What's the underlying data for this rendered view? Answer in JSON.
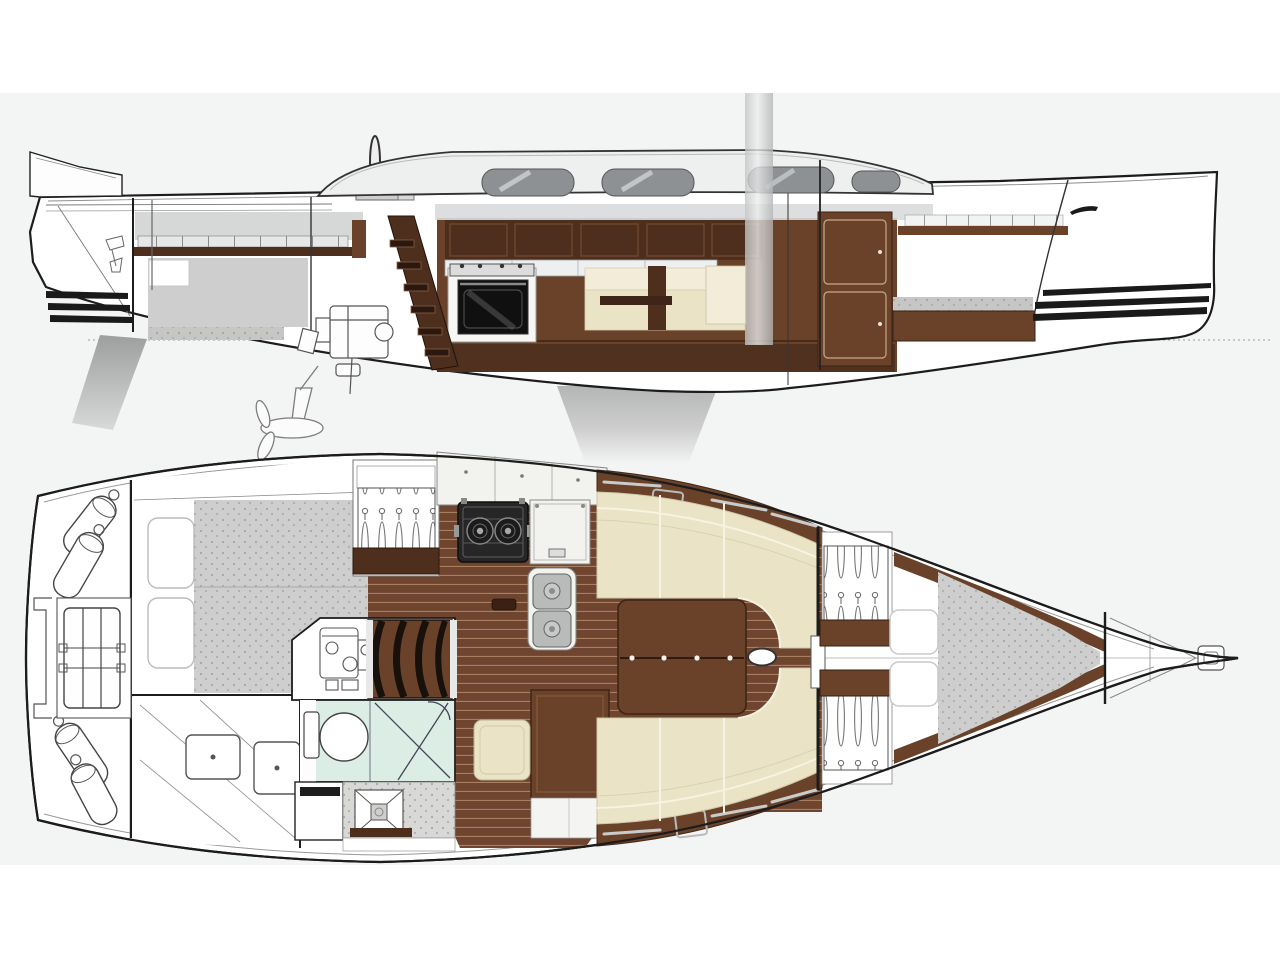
{
  "diagram": {
    "type": "yacht-general-arrangement",
    "views": [
      {
        "id": "side-profile",
        "label": "side profile cutaway",
        "parts": [
          "transom",
          "rudder",
          "keel",
          "propeller-saildrive",
          "engine",
          "cockpit",
          "steering-wheel",
          "aft-cabin-berth",
          "companionway-steps",
          "galley-oven",
          "overhead-lockers",
          "saloon-settee",
          "mast",
          "coachroof",
          "cabin-windows",
          "forward-bulkhead-doors",
          "forward-cabin-berth",
          "bow-accent-stripes",
          "stern-accent-stripes",
          "waterline"
        ]
      },
      {
        "id": "deck-plan",
        "label": "interior deck plan",
        "parts": [
          "transom-fenders",
          "liferaft-locker",
          "aft-cabin-double-berth",
          "aft-stowage-hatches",
          "engine-compartment",
          "companionway-steps",
          "heads-toilet",
          "shower",
          "shower-drain",
          "wet-locker",
          "wardrobe-hangers",
          "galley-stove",
          "galley-sink",
          "galley-counter",
          "chart-table",
          "chart-seat",
          "saloon-table",
          "port-l-settee",
          "starboard-settee",
          "side-lockers",
          "mast-section",
          "main-bulkhead-door",
          "forward-hanging-lockers",
          "v-berth",
          "pillows",
          "anchor-locker",
          "bow-fitting",
          "centerline"
        ]
      }
    ]
  },
  "palette": {
    "canvas": "#f3f4f4",
    "hull": "#ffffff",
    "line": "#1c1c1c",
    "wood_dark": "#4e2f1d",
    "wood_mid": "#6a4129",
    "wood_light": "#8a5c3e",
    "floor": "#6f4530",
    "plank": "#a9805f",
    "cushion": "#eae3c6",
    "cushion_light": "#f2ecd8",
    "counter": "#f2f2ef",
    "mattress": "#cdcecd",
    "speckle": "#9b9b99",
    "teal": "#dcede5",
    "steel": "#b8bbba",
    "stripe": "#1a1a1a",
    "superstructure": "#eef0f0",
    "window": "#8e9194",
    "headliner": "#d9dadb",
    "keel_gray": "#b7b8b8",
    "rudder_gray": "#a0a1a1",
    "slat_bg": "#e6e7e7"
  }
}
